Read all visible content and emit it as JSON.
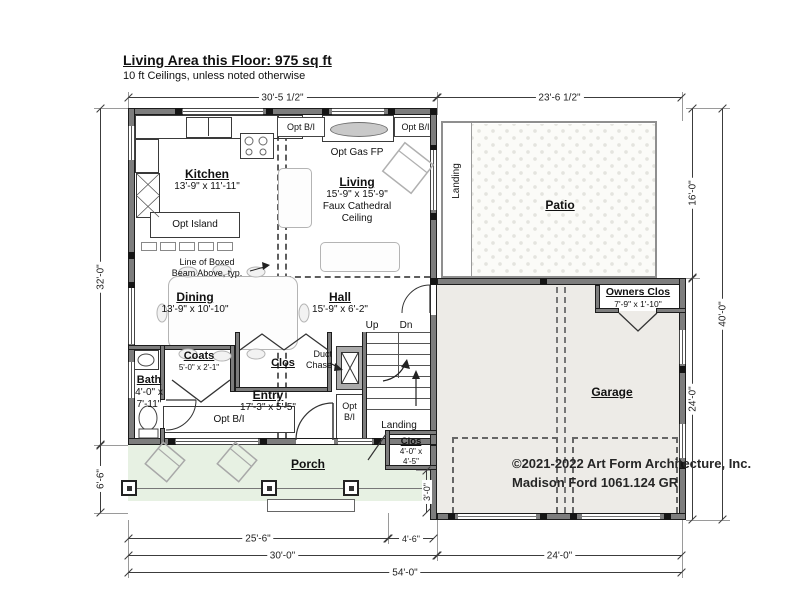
{
  "title": {
    "heading": "Living Area this Floor: 975 sq ft",
    "subheading": "10 ft Ceilings, unless noted otherwise"
  },
  "rooms": {
    "kitchen": {
      "name": "Kitchen",
      "dims": "13'-9\" x 11'-11\""
    },
    "living": {
      "name": "Living",
      "dims": "15'-9\" x 15'-9\"",
      "note_line1": "Faux Cathedral",
      "note_line2": "Ceiling"
    },
    "dining": {
      "name": "Dining",
      "dims": "13'-9\" x 10'-10\""
    },
    "hall": {
      "name": "Hall",
      "dims": "15'-9\" x 6'-2\""
    },
    "patio": {
      "name": "Patio"
    },
    "patio_landing": {
      "name": "Landing"
    },
    "garage": {
      "name": "Garage"
    },
    "owners_clos": {
      "name": "Owners Clos",
      "dims": "7'-9\" x 1'-10\""
    },
    "bath": {
      "name": "Bath",
      "dims_line1": "4'-0\" x",
      "dims_line2": "7'-11\""
    },
    "coats": {
      "name": "Coats",
      "dims": "5'-0\" x 2'-1\""
    },
    "entry_clos": {
      "name": "Clos"
    },
    "entry": {
      "name": "Entry",
      "dims": "17'-3\" x 5'-5\""
    },
    "porch": {
      "name": "Porch"
    },
    "porch_clos": {
      "name": "Clos",
      "dims_line1": "4'-0\" x",
      "dims_line2": "4'-5\""
    },
    "stair_landing": {
      "name": "Landing"
    }
  },
  "annotations": {
    "opt_island": "Opt Island",
    "opt_gas_fp": "Opt Gas FP",
    "opt_bi": "Opt B/I",
    "opt": "Opt",
    "bi": "B/I",
    "dw": "DW",
    "boxed_beam_line1": "Line of Boxed",
    "boxed_beam_line2": "Beam Above, typ.",
    "duct_line1": "Duct",
    "duct_line2": "Chase",
    "up": "Up",
    "dn": "Dn"
  },
  "dimensions": {
    "top_house": "30'-5 1/2\"",
    "top_patio": "23'-6 1/2\"",
    "left_house": "32'-0\"",
    "left_porch": "6'-6\"",
    "right_patio": "16'-0\"",
    "right_garage": "24'-0\"",
    "right_total": "40'-0\"",
    "right_clos_passage": "3'-0\"",
    "bottom_porch": "25'-6\"",
    "bottom_clos": "4'-6\"",
    "bottom_house": "30'-0\"",
    "bottom_garage": "24'-0\"",
    "bottom_total": "54'-0\""
  },
  "copyright": {
    "line1": "©2021-2022 Art Form Architecture, Inc.",
    "line2": "Madison Ford 1061.124 GR"
  },
  "colors": {
    "porch_fill": "#e7f1e3",
    "garage_fill": "#edebe7",
    "wall": "#7d7d7d"
  }
}
